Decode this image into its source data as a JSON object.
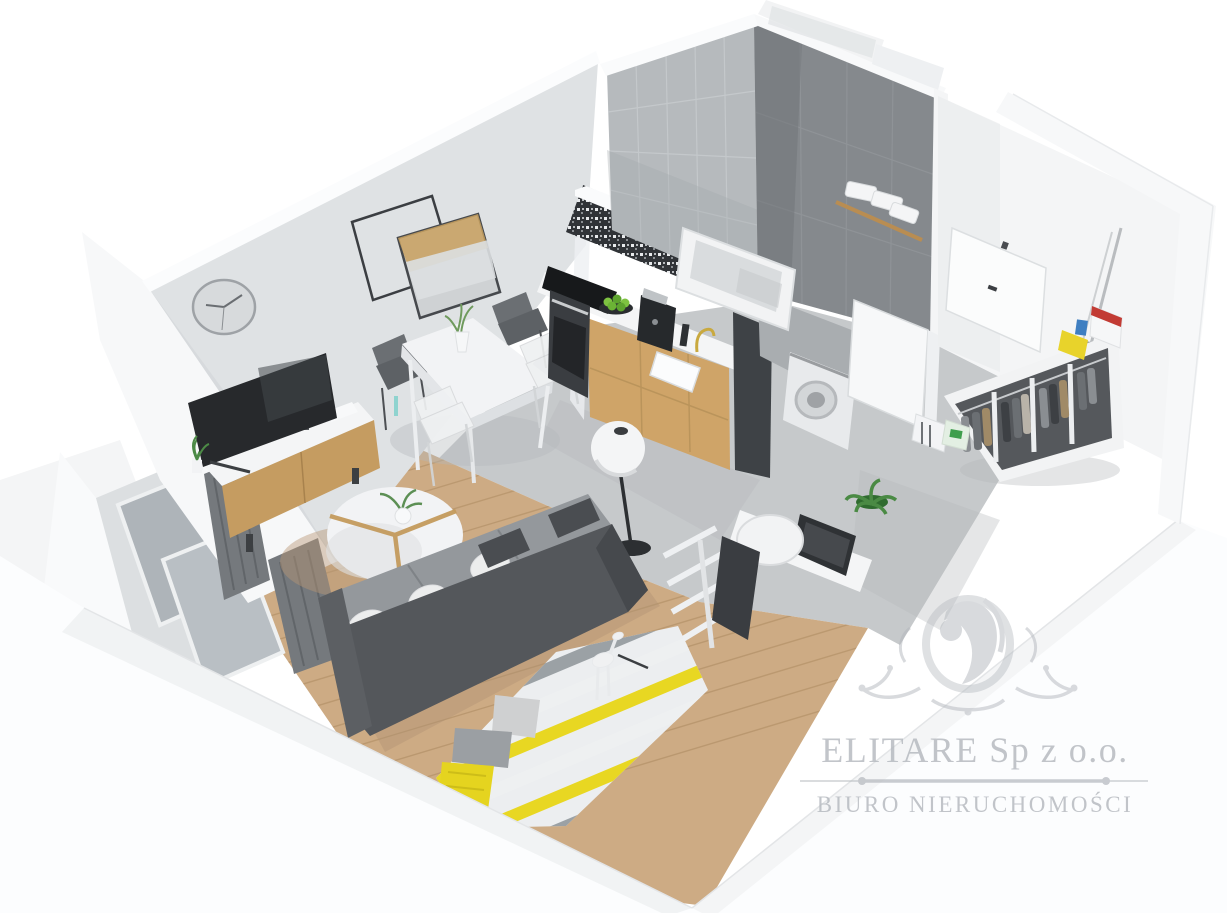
{
  "page": {
    "background": "#ffffff",
    "description": "3D cutaway floor-plan render of a studio apartment"
  },
  "watermark": {
    "logo_icon": "lion-crest-ornament",
    "brand": "ELITARE Sp z o.o.",
    "tagline": "BIURO NIERUCHOMOŚCI",
    "color": "#b3b7bd"
  },
  "apartment": {
    "rooms": [
      {
        "id": "living-room",
        "items": [
          "wall-clock",
          "decor-frame",
          "wall-mirror",
          "tv",
          "tv-console",
          "dining-table",
          "dining-chairs",
          "sofa",
          "white-pillows",
          "coffee-table",
          "floor-lamp",
          "striped-rug",
          "cushions",
          "yellow-blanket",
          "toys",
          "wood-floor"
        ]
      },
      {
        "id": "kitchen",
        "items": [
          "oven",
          "cooktop",
          "mosaic-backsplash",
          "wood-cabinets",
          "countertop",
          "sink",
          "gold-faucet",
          "coffee-machine",
          "fruit-plate"
        ]
      },
      {
        "id": "bathroom",
        "items": [
          "light-tiled-wall",
          "dark-tiled-wall",
          "bathtub",
          "towel-shelf",
          "towels",
          "washing-machine",
          "bathroom-door"
        ]
      },
      {
        "id": "hallway",
        "items": [
          "entrance-door",
          "open-wardrobe",
          "hanging-clothes",
          "storage-boxes",
          "mop",
          "detergent-boxes",
          "potted-plant",
          "desk",
          "desk-chair",
          "laptop",
          "ladder-shelf"
        ]
      },
      {
        "id": "balcony",
        "items": [
          "sliding-glass-doors",
          "radiator",
          "small-plant"
        ]
      }
    ],
    "palette": {
      "wall": "#dfe2e4",
      "tile_light": "#b6babd",
      "tile_dark": "#85898d",
      "wood_cabinet": "#cfa468",
      "wood_floor": "#cdab84",
      "sofa": "#54575b",
      "rug_yellow": "#e8d722",
      "plant_green": "#4a8a44",
      "floor_gray": "#c6c9cb"
    }
  }
}
